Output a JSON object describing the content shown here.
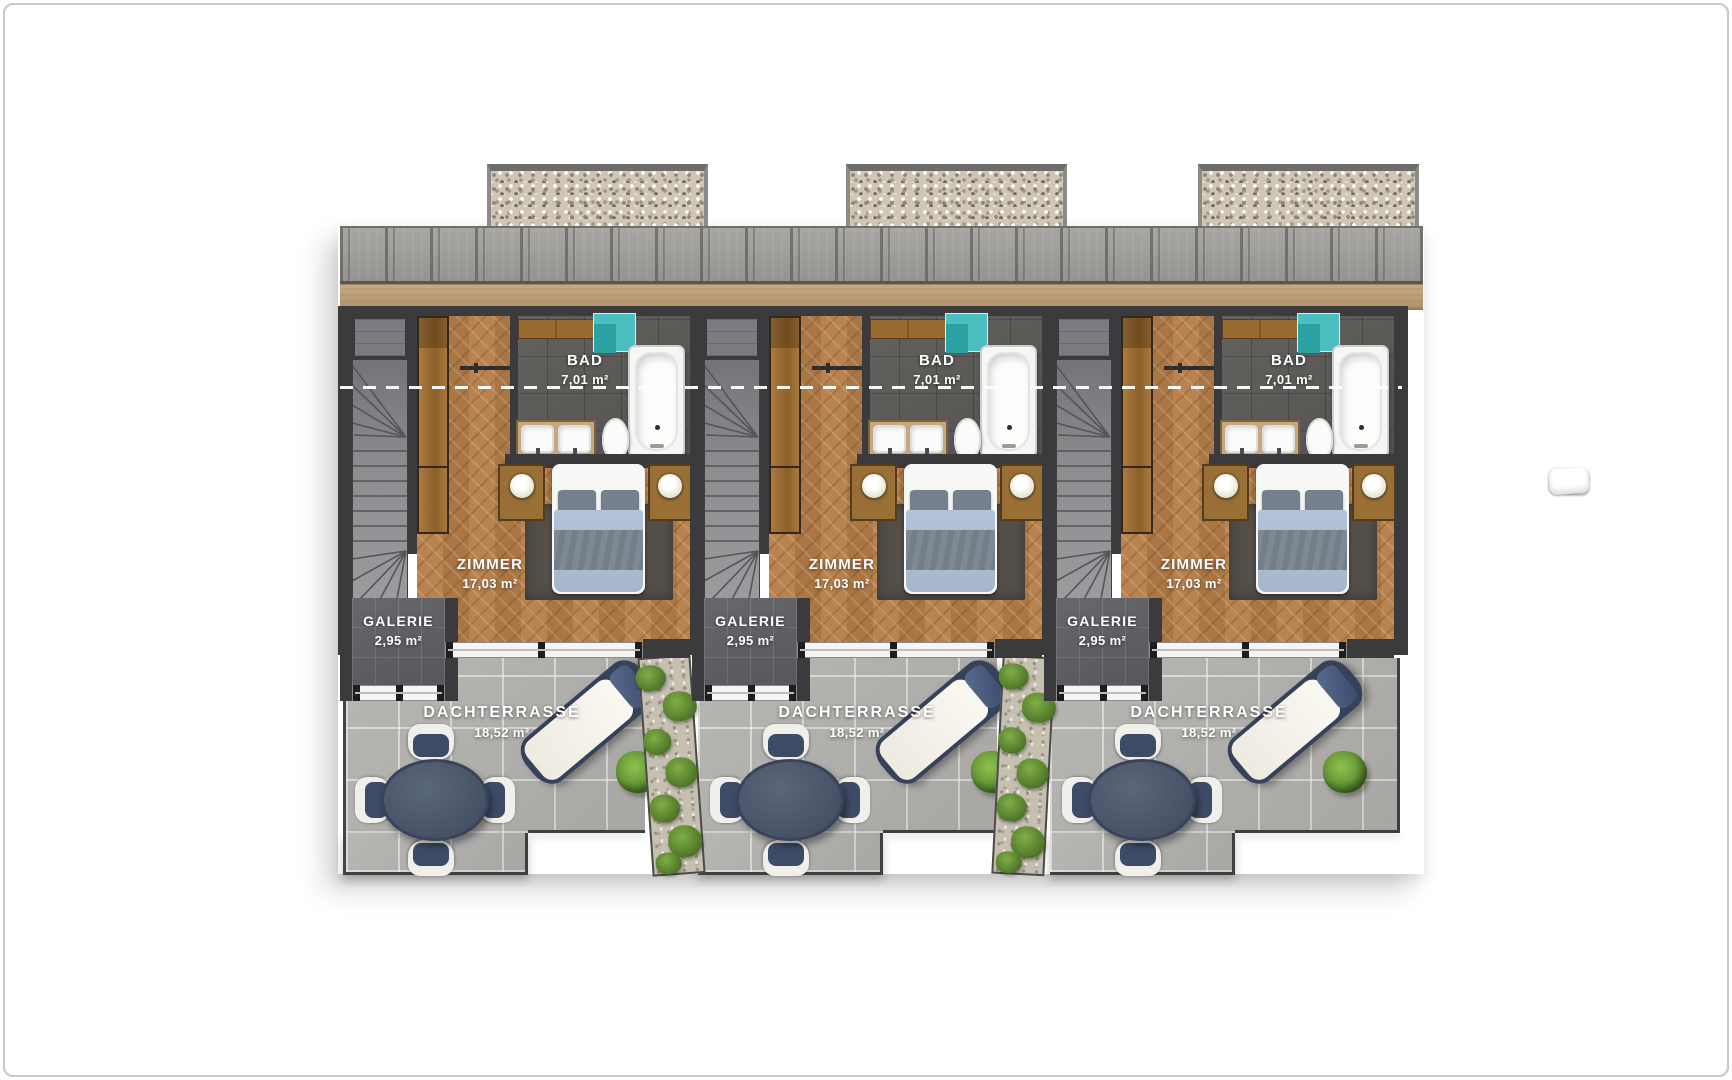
{
  "units": [
    {
      "id": "unit-1",
      "rooms": {
        "bad": {
          "name": "BAD",
          "area": "7,01 m²"
        },
        "zimmer": {
          "name": "ZIMMER",
          "area": "17,03 m²"
        },
        "galerie": {
          "name": "GALERIE",
          "area": "2,95 m²"
        },
        "dachterrasse": {
          "name": "DACHTERRASSE",
          "area": "18,52 m²"
        }
      }
    },
    {
      "id": "unit-2",
      "rooms": {
        "bad": {
          "name": "BAD",
          "area": "7,01 m²"
        },
        "zimmer": {
          "name": "ZIMMER",
          "area": "17,03 m²"
        },
        "galerie": {
          "name": "GALERIE",
          "area": "2,95 m²"
        },
        "dachterrasse": {
          "name": "DACHTERRASSE",
          "area": "18,52 m²"
        }
      }
    },
    {
      "id": "unit-3",
      "rooms": {
        "bad": {
          "name": "BAD",
          "area": "7,01 m²"
        },
        "zimmer": {
          "name": "ZIMMER",
          "area": "17,03 m²"
        },
        "galerie": {
          "name": "GALERIE",
          "area": "2,95 m²"
        },
        "dachterrasse": {
          "name": "DACHTERRASSE",
          "area": "18,52 m²"
        }
      }
    }
  ],
  "colors": {
    "wall": "#3b3b3d",
    "fascia": "#c9aa80",
    "shower": "#4bbec0",
    "terrace_tile": "#b2b1ae",
    "bed_blanket": "#b3c2d6",
    "bed_cushion": "#74808d",
    "table_navy": "#475266",
    "chair_navy": "#3d4b66",
    "lounger_navy": "#36415a",
    "bush_green": "#619433",
    "planter_green": "#567f2d",
    "label_text": "#ffffff"
  }
}
